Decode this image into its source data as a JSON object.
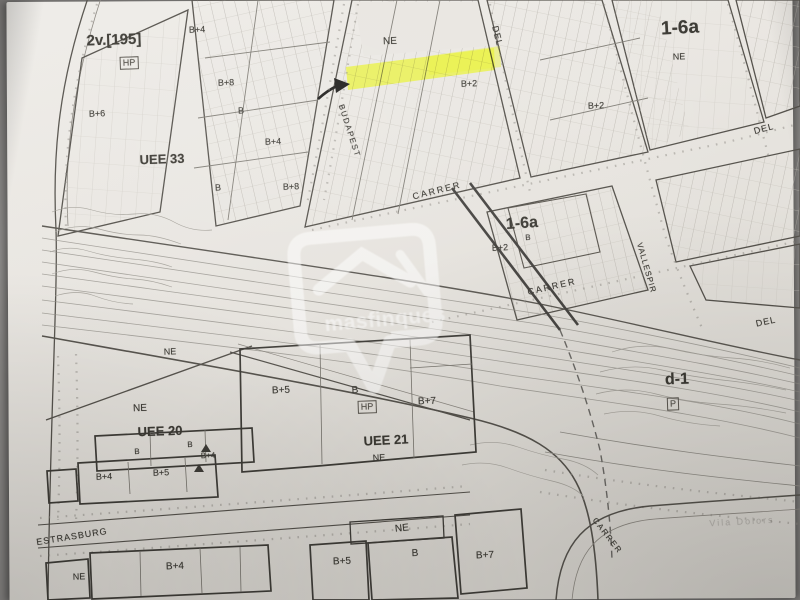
{
  "colors": {
    "backdrop": "#8a8886",
    "paper": "#e9e6e1",
    "paper-dark": "#d6d3cd",
    "ink": "#49463f",
    "ink-soft": "#8c8982",
    "label": "#3c3a34",
    "highlight": "#e9f23c",
    "watermark": "#ffffff80"
  },
  "map": {
    "watermark": {
      "text": "masfinques"
    },
    "icons": [
      {
        "name": "highlight-arrow",
        "glyph": "arrow-pointing-right-at-highlighted-parcel"
      },
      {
        "name": "watermark-pin",
        "glyph": "map-pin-with-house-roof"
      }
    ],
    "labels": [
      {
        "name": "plan-reference",
        "text": "2v.[195]",
        "x": 114,
        "y": 40,
        "size": 15,
        "bold": true,
        "rot": -2
      },
      {
        "name": "hp-tag",
        "text": "HP",
        "x": 129,
        "y": 63,
        "size": 9,
        "boxed": true,
        "rot": -2
      },
      {
        "name": "hp-tag",
        "text": "HP",
        "x": 367,
        "y": 407,
        "size": 9,
        "boxed": true,
        "rot": -2
      },
      {
        "name": "parking-tag",
        "text": "P",
        "x": 673,
        "y": 404,
        "size": 9,
        "boxed": true,
        "rot": -2
      },
      {
        "name": "zone-label",
        "text": "UEE 33",
        "x": 162,
        "y": 159,
        "size": 13,
        "bold": true,
        "rot": -2
      },
      {
        "name": "zone-label",
        "text": "UEE 20",
        "x": 160,
        "y": 431,
        "size": 13,
        "bold": true,
        "rot": -2
      },
      {
        "name": "zone-label",
        "text": "UEE 21",
        "x": 386,
        "y": 440,
        "size": 13,
        "bold": true,
        "rot": -3
      },
      {
        "name": "zone-label",
        "text": "1-6a",
        "x": 680,
        "y": 28,
        "size": 19,
        "bold": true,
        "rot": -3
      },
      {
        "name": "zone-label",
        "text": "1-6a",
        "x": 522,
        "y": 224,
        "size": 16,
        "bold": true,
        "rot": -4
      },
      {
        "name": "zone-label",
        "text": "d-1",
        "x": 677,
        "y": 380,
        "size": 16,
        "bold": true,
        "rot": -2
      },
      {
        "name": "zone-label",
        "text": "NE",
        "x": 390,
        "y": 42,
        "size": 10,
        "rot": -2
      },
      {
        "name": "zone-label",
        "text": "NE",
        "x": 679,
        "y": 57,
        "size": 9,
        "rot": -2
      },
      {
        "name": "zone-label",
        "text": "NE",
        "x": 170,
        "y": 352,
        "size": 9,
        "rot": -2
      },
      {
        "name": "zone-label",
        "text": "NE",
        "x": 140,
        "y": 409,
        "size": 10,
        "rot": -2
      },
      {
        "name": "zone-label",
        "text": "NE",
        "x": 379,
        "y": 458,
        "size": 9,
        "rot": -3
      },
      {
        "name": "zone-label",
        "text": "NE",
        "x": 402,
        "y": 529,
        "size": 10,
        "rot": -6
      },
      {
        "name": "zone-label",
        "text": "NE",
        "x": 79,
        "y": 577,
        "size": 9,
        "rot": -2
      },
      {
        "name": "building-height-label",
        "text": "B+4",
        "x": 197,
        "y": 30,
        "size": 9,
        "rot": -2
      },
      {
        "name": "building-height-label",
        "text": "B+8",
        "x": 226,
        "y": 83,
        "size": 9,
        "rot": -2
      },
      {
        "name": "building-height-label",
        "text": "B+6",
        "x": 97,
        "y": 114,
        "size": 9,
        "rot": -2
      },
      {
        "name": "building-height-label",
        "text": "B",
        "x": 241,
        "y": 111,
        "size": 9,
        "rot": -2
      },
      {
        "name": "building-height-label",
        "text": "B+4",
        "x": 273,
        "y": 142,
        "size": 9,
        "rot": -2
      },
      {
        "name": "building-height-label",
        "text": "B",
        "x": 218,
        "y": 188,
        "size": 9,
        "rot": -2
      },
      {
        "name": "building-height-label",
        "text": "B+8",
        "x": 291,
        "y": 187,
        "size": 9,
        "rot": -2
      },
      {
        "name": "building-height-label",
        "text": "B+2",
        "x": 469,
        "y": 84,
        "size": 9,
        "rot": -2
      },
      {
        "name": "building-height-label",
        "text": "B+2",
        "x": 596,
        "y": 106,
        "size": 9,
        "rot": -2
      },
      {
        "name": "building-height-label",
        "text": "B",
        "x": 528,
        "y": 238,
        "size": 8,
        "rot": -3
      },
      {
        "name": "building-height-label",
        "text": "B+2",
        "x": 500,
        "y": 248,
        "size": 9,
        "rot": -3
      },
      {
        "name": "building-height-label",
        "text": "B+5",
        "x": 281,
        "y": 391,
        "size": 10,
        "rot": -2
      },
      {
        "name": "building-height-label",
        "text": "B",
        "x": 355,
        "y": 391,
        "size": 10,
        "rot": -2
      },
      {
        "name": "building-height-label",
        "text": "B+7",
        "x": 427,
        "y": 402,
        "size": 10,
        "rot": -2
      },
      {
        "name": "building-height-label",
        "text": "B",
        "x": 137,
        "y": 452,
        "size": 8,
        "rot": -2
      },
      {
        "name": "building-height-label",
        "text": "B",
        "x": 190,
        "y": 445,
        "size": 8,
        "rot": -2
      },
      {
        "name": "building-height-label",
        "text": "B+4",
        "x": 208,
        "y": 456,
        "size": 8,
        "rot": -2
      },
      {
        "name": "building-height-label",
        "text": "B+4",
        "x": 104,
        "y": 477,
        "size": 9,
        "rot": -2
      },
      {
        "name": "building-height-label",
        "text": "B+5",
        "x": 161,
        "y": 473,
        "size": 9,
        "rot": -2
      },
      {
        "name": "building-height-label",
        "text": "B+4",
        "x": 175,
        "y": 567,
        "size": 10,
        "rot": -2
      },
      {
        "name": "building-height-label",
        "text": "B+5",
        "x": 342,
        "y": 562,
        "size": 10,
        "rot": -2
      },
      {
        "name": "building-height-label",
        "text": "B",
        "x": 415,
        "y": 554,
        "size": 10,
        "rot": -2
      },
      {
        "name": "building-height-label",
        "text": "B+7",
        "x": 485,
        "y": 556,
        "size": 10,
        "rot": -2
      },
      {
        "name": "street-label",
        "text": "BUDAPEST",
        "x": 349,
        "y": 131,
        "size": 8,
        "rot": 72,
        "spacing": 1.5
      },
      {
        "name": "street-label",
        "text": "DEL",
        "x": 497,
        "y": 36,
        "size": 9,
        "rot": 76,
        "spacing": 1
      },
      {
        "name": "street-label",
        "text": "CARRER",
        "x": 437,
        "y": 191,
        "size": 9,
        "rot": -14,
        "spacing": 2
      },
      {
        "name": "street-label",
        "text": "CARRER",
        "x": 552,
        "y": 287,
        "size": 9,
        "rot": -13,
        "spacing": 2
      },
      {
        "name": "street-label",
        "text": "VALLESPIR",
        "x": 646,
        "y": 268,
        "size": 8,
        "rot": 74,
        "spacing": 1
      },
      {
        "name": "street-label",
        "text": "DEL",
        "x": 766,
        "y": 322,
        "size": 9,
        "rot": -12,
        "spacing": 1
      },
      {
        "name": "street-label",
        "text": "DEL",
        "x": 764,
        "y": 129,
        "size": 9,
        "rot": -15,
        "spacing": 1
      },
      {
        "name": "street-label",
        "text": "ESTRASBURG",
        "x": 72,
        "y": 537,
        "size": 9,
        "rot": -9,
        "spacing": 1
      },
      {
        "name": "street-label",
        "text": "CARRER",
        "x": 607,
        "y": 536,
        "size": 8,
        "rot": 52,
        "spacing": 1.5
      },
      {
        "name": "faint-place-label",
        "text": "Vila Dolors",
        "x": 742,
        "y": 522,
        "size": 9,
        "rot": -3,
        "faint": true,
        "spacing": 2
      }
    ]
  }
}
